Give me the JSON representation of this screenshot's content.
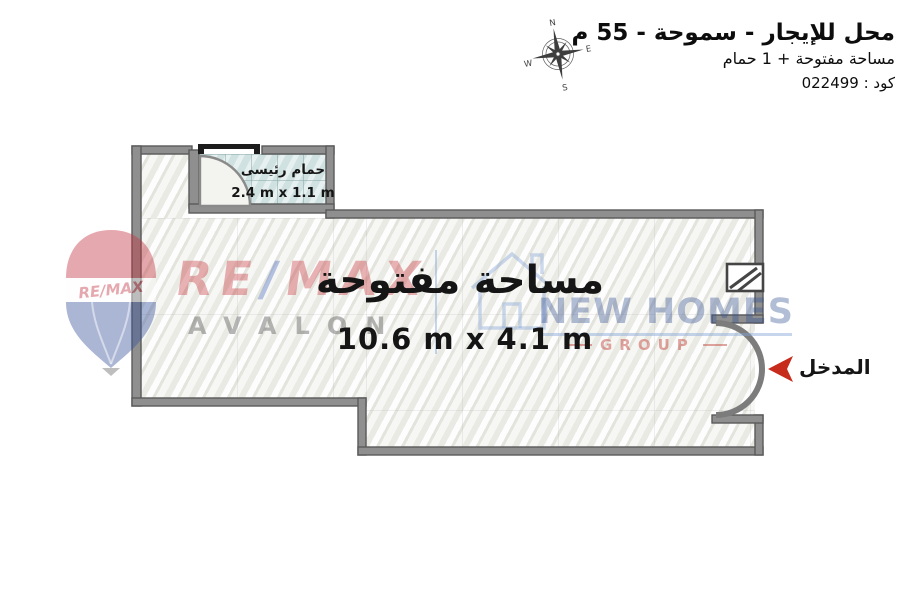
{
  "header": {
    "title": "محل للإيجار - سموحة - 55 م",
    "subtitle": "مساحة مفتوحة + 1 حمام",
    "code": "كود : 022499"
  },
  "compass": {
    "north": "N",
    "east": "E",
    "south": "S",
    "west": "W"
  },
  "plan": {
    "open_area": {
      "name": "مساحة مفتوحة",
      "dimensions": "10.6 m x 4.1 m"
    },
    "bathroom": {
      "name": "حمام رئيسى",
      "dimensions": "2.4 m x 1.1 m"
    },
    "entrance": {
      "label": "المدخل"
    }
  },
  "watermarks": {
    "remax": {
      "part1": "RE",
      "slash": "/",
      "part2": "MAX",
      "office": "AVALON",
      "balloon_text": "RE/MAX"
    },
    "new_homes": {
      "name": "NEW HOMES",
      "group": "GROUP"
    }
  },
  "colors": {
    "wall_fill": "#8f8f8f",
    "wall_edge": "#5a5a5a",
    "tile": "#cfe2e1",
    "arrow_red": "#c62b1c",
    "remax_red": "rgba(198,52,58,0.38)",
    "remax_slash_blue": "rgba(95,125,200,0.45)",
    "avalon_gray": "rgba(110,110,110,0.5)",
    "homes_navy": "rgba(52,82,148,0.38)",
    "homes_blue": "rgba(130,165,215,0.45)",
    "group_red": "rgba(190,58,48,0.45)"
  }
}
